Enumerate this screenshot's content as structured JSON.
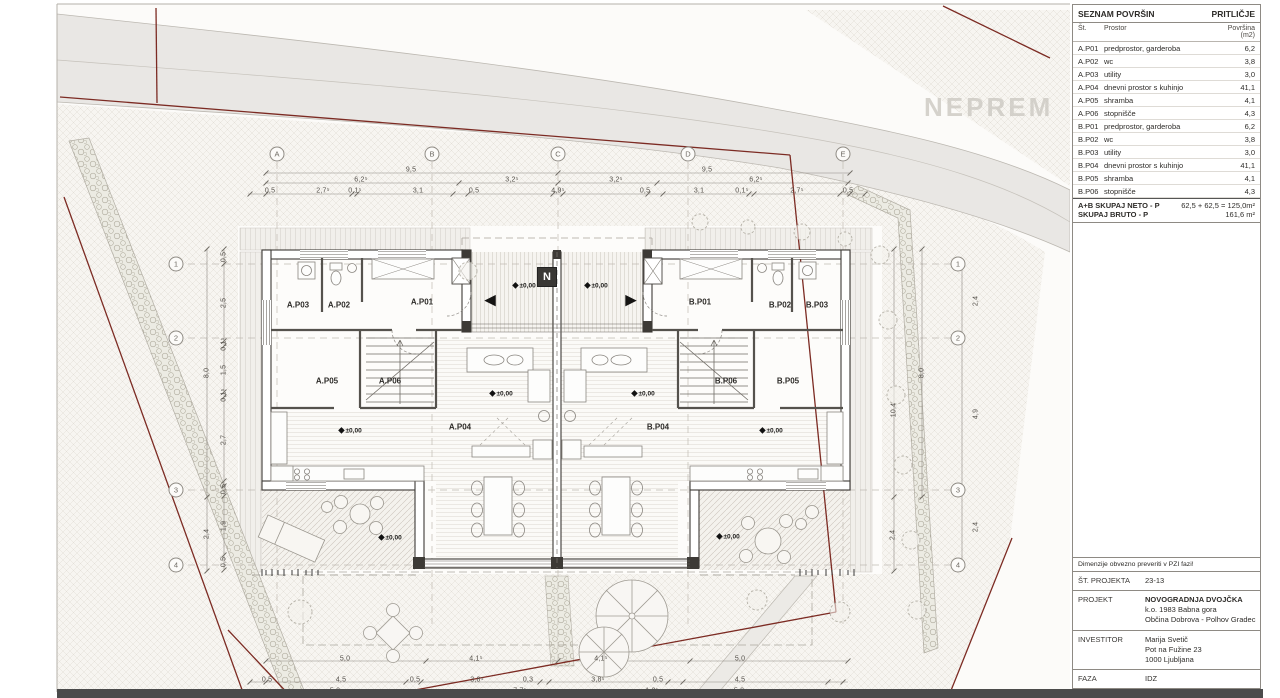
{
  "watermark": "NEPREM",
  "plan": {
    "north": {
      "label": "N",
      "x": 547,
      "y": 277
    },
    "level_text": "±0,00",
    "level_icon": "◆",
    "levels": [
      {
        "x": 524,
        "y": 285
      },
      {
        "x": 596,
        "y": 285
      },
      {
        "x": 501,
        "y": 393
      },
      {
        "x": 643,
        "y": 393
      },
      {
        "x": 350,
        "y": 430
      },
      {
        "x": 771,
        "y": 430
      },
      {
        "x": 390,
        "y": 537
      },
      {
        "x": 728,
        "y": 536
      }
    ],
    "arrows": [
      {
        "glyph": "◀",
        "x": 490,
        "y": 300
      },
      {
        "glyph": "▶",
        "x": 631,
        "y": 300
      }
    ],
    "grid_columns": {
      "y": 154,
      "items": [
        {
          "label": "A",
          "x": 277
        },
        {
          "label": "B",
          "x": 432
        },
        {
          "label": "C",
          "x": 558
        },
        {
          "label": "D",
          "x": 688
        },
        {
          "label": "E",
          "x": 843
        }
      ]
    },
    "grid_rows": {
      "left_x": 176,
      "right_x": 958,
      "ys": [
        264,
        338,
        490,
        565
      ],
      "labels": [
        "1",
        "2",
        "3",
        "4"
      ]
    },
    "rooms": [
      {
        "t": "A.P03",
        "x": 298,
        "y": 305
      },
      {
        "t": "A.P02",
        "x": 339,
        "y": 305
      },
      {
        "t": "A.P01",
        "x": 422,
        "y": 302
      },
      {
        "t": "B.P01",
        "x": 700,
        "y": 302
      },
      {
        "t": "B.P02",
        "x": 780,
        "y": 305
      },
      {
        "t": "B.P03",
        "x": 817,
        "y": 305
      },
      {
        "t": "A.P05",
        "x": 327,
        "y": 381
      },
      {
        "t": "A.P06",
        "x": 390,
        "y": 381
      },
      {
        "t": "B.P06",
        "x": 726,
        "y": 381
      },
      {
        "t": "B.P05",
        "x": 788,
        "y": 381
      },
      {
        "t": "A.P04",
        "x": 460,
        "y": 427
      },
      {
        "t": "B.P04",
        "x": 658,
        "y": 427
      }
    ],
    "dims": [
      {
        "t": "9,5",
        "x": 411,
        "y": 170
      },
      {
        "t": "9,5",
        "x": 707,
        "y": 170
      },
      {
        "t": "6,2⁵",
        "x": 361,
        "y": 180
      },
      {
        "t": "3,2⁵",
        "x": 512,
        "y": 180
      },
      {
        "t": "3,2⁵",
        "x": 616,
        "y": 180
      },
      {
        "t": "6,2⁵",
        "x": 756,
        "y": 180
      },
      {
        "t": "0,5",
        "x": 270,
        "y": 191
      },
      {
        "t": "2,7⁵",
        "x": 323,
        "y": 191
      },
      {
        "t": "0,1⁵",
        "x": 355,
        "y": 191
      },
      {
        "t": "3,1",
        "x": 418,
        "y": 191
      },
      {
        "t": "0,5",
        "x": 474,
        "y": 191
      },
      {
        "t": "4,9⁵",
        "x": 558,
        "y": 191
      },
      {
        "t": "0,5",
        "x": 645,
        "y": 191
      },
      {
        "t": "3,1",
        "x": 699,
        "y": 191
      },
      {
        "t": "0,1⁵",
        "x": 742,
        "y": 191
      },
      {
        "t": "2,7⁵",
        "x": 797,
        "y": 191
      },
      {
        "t": "0,5",
        "x": 848,
        "y": 191
      },
      {
        "t": "0,5",
        "x": 224,
        "y": 257,
        "v": 1
      },
      {
        "t": "2,5",
        "x": 224,
        "y": 303,
        "v": 1
      },
      {
        "t": "0,1⁵",
        "x": 224,
        "y": 344,
        "v": 1
      },
      {
        "t": "1,5",
        "x": 224,
        "y": 370,
        "v": 1
      },
      {
        "t": "0,1⁵",
        "x": 224,
        "y": 395,
        "v": 1
      },
      {
        "t": "2,7",
        "x": 224,
        "y": 440,
        "v": 1
      },
      {
        "t": "0,5",
        "x": 224,
        "y": 489,
        "v": 1
      },
      {
        "t": "1,9",
        "x": 224,
        "y": 526,
        "v": 1
      },
      {
        "t": "0,5",
        "x": 224,
        "y": 562,
        "v": 1
      },
      {
        "t": "8,0",
        "x": 207,
        "y": 373,
        "v": 1
      },
      {
        "t": "2,4",
        "x": 207,
        "y": 534,
        "v": 1
      },
      {
        "t": "8,0",
        "x": 922,
        "y": 373,
        "v": 1
      },
      {
        "t": "10,4",
        "x": 894,
        "y": 410,
        "v": 1
      },
      {
        "t": "2,4",
        "x": 893,
        "y": 535,
        "v": 1
      },
      {
        "t": "2,4",
        "x": 976,
        "y": 301,
        "v": 1
      },
      {
        "t": "4,9",
        "x": 976,
        "y": 414,
        "v": 1
      },
      {
        "t": "2,4",
        "x": 976,
        "y": 527,
        "v": 1
      },
      {
        "t": "5,0",
        "x": 345,
        "y": 659
      },
      {
        "t": "4,1⁵",
        "x": 476,
        "y": 659
      },
      {
        "t": "4,1⁵",
        "x": 601,
        "y": 659
      },
      {
        "t": "5,0",
        "x": 740,
        "y": 659
      },
      {
        "t": "0,5",
        "x": 267,
        "y": 680
      },
      {
        "t": "4,5",
        "x": 341,
        "y": 680
      },
      {
        "t": "0,5",
        "x": 415,
        "y": 680
      },
      {
        "t": "3,8⁵",
        "x": 477,
        "y": 680
      },
      {
        "t": "0,3",
        "x": 528,
        "y": 680
      },
      {
        "t": "3,8⁵",
        "x": 598,
        "y": 680
      },
      {
        "t": "0,5",
        "x": 658,
        "y": 680
      },
      {
        "t": "4,5",
        "x": 740,
        "y": 680
      },
      {
        "t": "5,0",
        "x": 335,
        "y": 691
      },
      {
        "t": "7,7⁵",
        "x": 520,
        "y": 691
      },
      {
        "t": "1,2⁵",
        "x": 652,
        "y": 691
      },
      {
        "t": "5,0",
        "x": 739,
        "y": 691
      }
    ]
  },
  "panel": {
    "area_table": {
      "title": "SEZNAM POVRŠIN",
      "title_right": "PRITLIČJE",
      "col_no": "Št.",
      "col_room": "Prostor",
      "col_area": "Površina (m2)",
      "rows": [
        {
          "no": "A.P01",
          "room": "predprostor, garderoba",
          "area": "6,2"
        },
        {
          "no": "A.P02",
          "room": "wc",
          "area": "3,8"
        },
        {
          "no": "A.P03",
          "room": "utility",
          "area": "3,0"
        },
        {
          "no": "A.P04",
          "room": "dnevni prostor s kuhinjo",
          "area": "41,1"
        },
        {
          "no": "A.P05",
          "room": "shramba",
          "area": "4,1"
        },
        {
          "no": "A.P06",
          "room": "stopnišče",
          "area": "4,3"
        },
        {
          "no": "B.P01",
          "room": "predprostor, garderoba",
          "area": "6,2"
        },
        {
          "no": "B.P02",
          "room": "wc",
          "area": "3,8"
        },
        {
          "no": "B.P03",
          "room": "utility",
          "area": "3,0"
        },
        {
          "no": "B.P04",
          "room": "dnevni prostor s kuhinjo",
          "area": "41,1"
        },
        {
          "no": "B.P05",
          "room": "shramba",
          "area": "4,1"
        },
        {
          "no": "B.P06",
          "room": "stopnišče",
          "area": "4,3"
        }
      ],
      "sum1_label": "A+B SKUPAJ NETO - P",
      "sum1_value": "62,5 + 62,5 = 125,0m²",
      "sum2_label": "SKUPAJ BRUTO - P",
      "sum2_value": "161,6 m²"
    },
    "title_block": {
      "note": "Dimenzije obvezno preveriti v PZI fazi!",
      "project_no_label": "ŠT. PROJEKTA",
      "project_no": "23-13",
      "project_label": "PROJEKT",
      "project_name": "NOVOGRADNJA DVOJČKA",
      "project_desc1": "k.o. 1983 Babna gora",
      "project_desc2": "Občina Dobrova - Polhov Gradec",
      "investor_label": "INVESTITOR",
      "investor_name": "Marija Svetič",
      "investor_addr1": "Pot na Fužine 23",
      "investor_addr2": "1000 Ljubljana",
      "phase_label": "FAZA",
      "phase": "IDZ"
    }
  }
}
